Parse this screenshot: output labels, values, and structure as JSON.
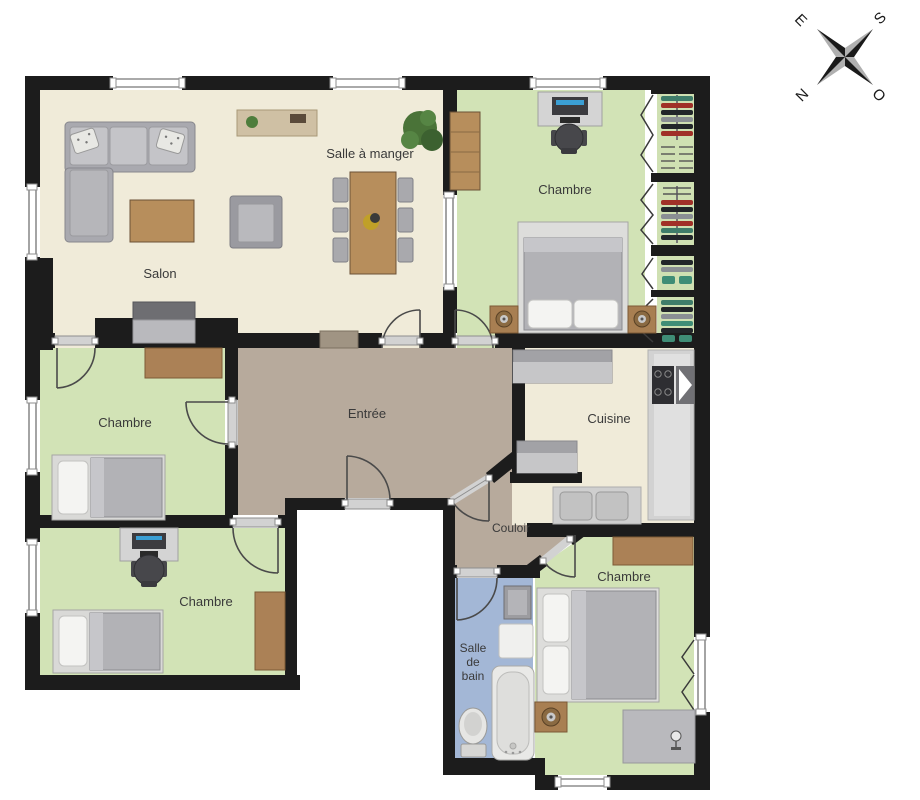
{
  "compass": {
    "e": "E",
    "s": "S",
    "n": "N",
    "o": "O"
  },
  "rooms": {
    "salle_a_manger": {
      "label": "Salle à manger"
    },
    "salon": {
      "label": "Salon"
    },
    "chambre_tr": {
      "label": "Chambre"
    },
    "chambre_ml": {
      "label": "Chambre"
    },
    "chambre_bl": {
      "label": "Chambre"
    },
    "chambre_br": {
      "label": "Chambre"
    },
    "entree": {
      "label": "Entrée"
    },
    "cuisine": {
      "label": "Cuisine"
    },
    "couloir": {
      "label": "Couloir"
    },
    "salle_de_bain": {
      "line1": "Salle",
      "line2": "de",
      "line3": "bain"
    }
  },
  "colors": {
    "wall": "#1c1c1c",
    "floor_living": "#f0ebd9",
    "floor_bedroom": "#d2e3b6",
    "floor_hall": "#b7aa9c",
    "floor_bath": "#a3b7d6",
    "wood": "#b78e5c",
    "furniture_gray": "#a9a9af"
  }
}
